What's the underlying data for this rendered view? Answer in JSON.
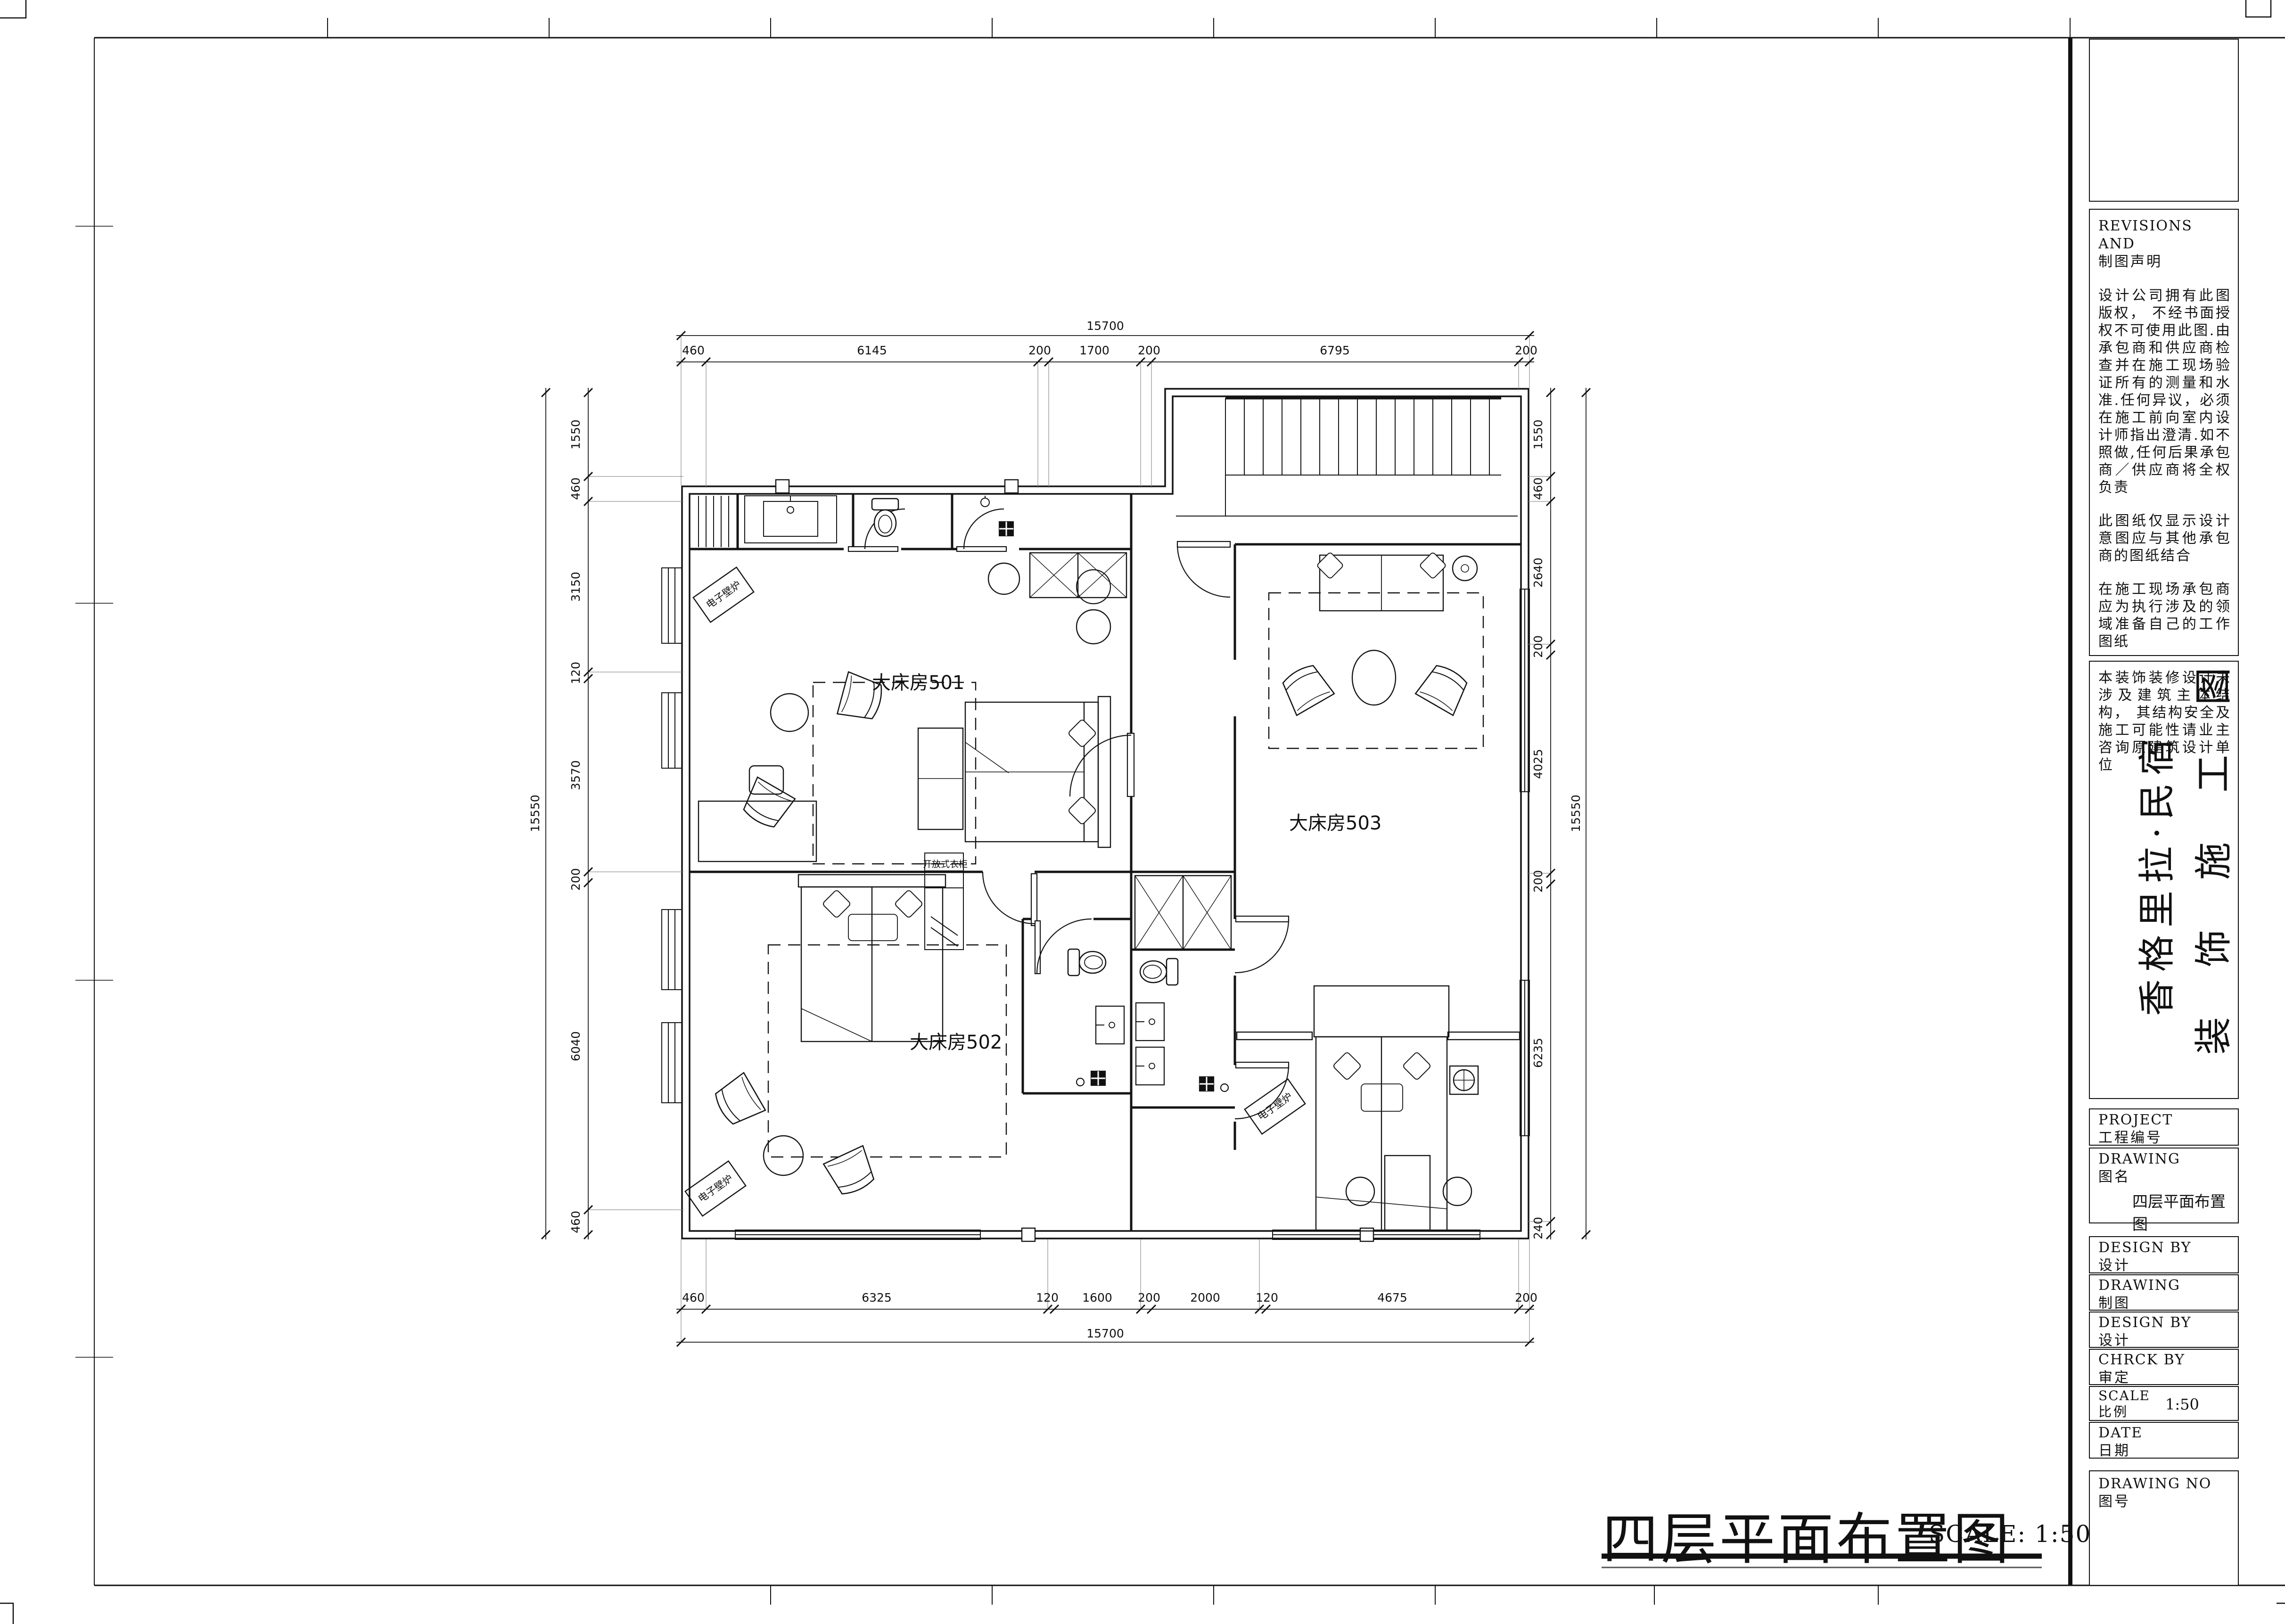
{
  "sheet": {
    "footer_title": "四层平面布置图",
    "footer_scale": "SCALE: 1:50"
  },
  "title_block": {
    "revisions_en": "REVISIONS  AND",
    "revisions_zh": "制图声明",
    "notes": [
      "设计公司拥有此图版权， 不经书面授权不可使用此图.由承包商和供应商检查并在施工现场验证所有的测量和水准.任何异议，必须在施工前向室内设计师指出澄清.如不照做,任何后果承包商／供应商将全权负责",
      "此图纸仅显示设计意图应与其他承包商的图纸结合",
      "在施工现场承包商应为执行涉及的领域准备自己的工作图纸",
      "所有的材料和框架的工作,承包商应遵守当地的法律和消防条例或向当地建筑师咨询",
      "本装饰装修设计未涉及建筑主体结构， 其结构安全及施工可能性请业主咨询原建筑设计单位"
    ],
    "project_title_vertical": "香格里拉·民宿",
    "project_subtitle_vertical": "装 饰 施 工 图",
    "fields": {
      "project": {
        "en": "PROJECT",
        "zh": "工程编号",
        "value": ""
      },
      "drawing_name": {
        "en": "DRAWING",
        "zh": "图名",
        "value": "四层平面布置图"
      },
      "design_by": {
        "en": "DESIGN BY",
        "zh": "设计",
        "value": ""
      },
      "drafting": {
        "en": "DRAWING",
        "zh": "制图",
        "value": ""
      },
      "design_by2": {
        "en": "DESIGN BY",
        "zh": "设计",
        "value": ""
      },
      "check_by": {
        "en": "CHRCK BY",
        "zh": "审定",
        "value": ""
      },
      "scale": {
        "en": "SCALE",
        "zh": "比例",
        "value": "1:50"
      },
      "date": {
        "en": "DATE",
        "zh": "日期",
        "value": ""
      },
      "drawing_no": {
        "en": "DRAWING NO",
        "zh": "图号",
        "value": ""
      }
    }
  },
  "plan": {
    "rooms": {
      "r501": "大床房501",
      "r502": "大床房502",
      "r503": "大床房503"
    },
    "annotations": {
      "fireplace": "电子壁炉",
      "open_wardrobe": "开放式衣柜"
    }
  },
  "dimensions": {
    "top": {
      "overall": "15700",
      "segments": [
        "460",
        "6145",
        "200",
        "1700",
        "200",
        "6795",
        "200"
      ]
    },
    "bottom": {
      "overall": "15700",
      "segments": [
        "460",
        "6325",
        "120",
        "1600",
        "200",
        "2000",
        "120",
        "4675",
        "200"
      ]
    },
    "left": {
      "overall": "15550",
      "segments": [
        "1550",
        "460",
        "3150",
        "120",
        "3570",
        "200",
        "6040",
        "460"
      ]
    },
    "right": {
      "overall": "15550",
      "segments": [
        "1550",
        "460",
        "2640",
        "200",
        "4025",
        "200",
        "6235",
        "240"
      ]
    }
  }
}
